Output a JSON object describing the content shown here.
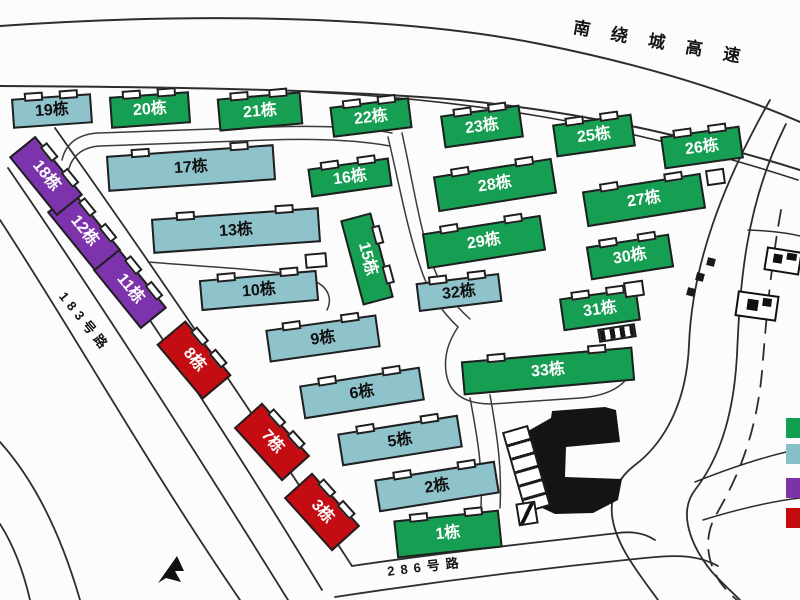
{
  "map": {
    "highway_label": "南绕城高速",
    "road_label_183": "183号路",
    "road_label_286": "286号路"
  },
  "palette": {
    "green": "#169e52",
    "teal": "#8fc3cc",
    "purple": "#7c33ab",
    "red": "#c30d12"
  },
  "text_colors": {
    "green": "#ffffff",
    "teal": "#101010",
    "purple": "#ffffff",
    "red": "#ffffff"
  },
  "legend": [
    {
      "key": "green",
      "color": "#0ea04f"
    },
    {
      "key": "teal",
      "color": "#87c0c9"
    },
    {
      "key": "purple",
      "color": "#7e32a8"
    },
    {
      "key": "red",
      "color": "#c50b0e"
    }
  ],
  "buildings": [
    {
      "label": "1栋",
      "type": "green",
      "x": 448,
      "y": 534,
      "w": 106,
      "h": 38,
      "rot": -6
    },
    {
      "label": "2栋",
      "type": "teal",
      "x": 437,
      "y": 486,
      "w": 122,
      "h": 33,
      "rot": -9
    },
    {
      "label": "3栋",
      "type": "red",
      "x": 322,
      "y": 512,
      "w": 72,
      "h": 38,
      "rot": 48
    },
    {
      "label": "5栋",
      "type": "teal",
      "x": 400,
      "y": 440,
      "w": 122,
      "h": 33,
      "rot": -9
    },
    {
      "label": "6栋",
      "type": "teal",
      "x": 362,
      "y": 393,
      "w": 122,
      "h": 34,
      "rot": -9
    },
    {
      "label": "7栋",
      "type": "red",
      "x": 272,
      "y": 442,
      "w": 72,
      "h": 38,
      "rot": 48
    },
    {
      "label": "8栋",
      "type": "red",
      "x": 194,
      "y": 360,
      "w": 72,
      "h": 38,
      "rot": 50
    },
    {
      "label": "9栋",
      "type": "teal",
      "x": 323,
      "y": 338,
      "w": 112,
      "h": 33,
      "rot": -8
    },
    {
      "label": "10栋",
      "type": "teal",
      "x": 259,
      "y": 290,
      "w": 118,
      "h": 31,
      "rot": -5
    },
    {
      "label": "11栋",
      "type": "purple",
      "x": 130,
      "y": 289,
      "w": 76,
      "h": 34,
      "rot": 51
    },
    {
      "label": "12栋",
      "type": "purple",
      "x": 84,
      "y": 231,
      "w": 76,
      "h": 34,
      "rot": 51
    },
    {
      "label": "13栋",
      "type": "teal",
      "x": 236,
      "y": 230,
      "w": 168,
      "h": 35,
      "rot": -4
    },
    {
      "label": "15栋",
      "type": "green",
      "x": 367,
      "y": 259,
      "w": 88,
      "h": 32,
      "rot": 75
    },
    {
      "label": "16栋",
      "type": "green",
      "x": 350,
      "y": 177,
      "w": 82,
      "h": 29,
      "rot": -8
    },
    {
      "label": "17栋",
      "type": "teal",
      "x": 191,
      "y": 168,
      "w": 168,
      "h": 36,
      "rot": -4
    },
    {
      "label": "18栋",
      "type": "purple",
      "x": 46,
      "y": 176,
      "w": 76,
      "h": 34,
      "rot": 51
    },
    {
      "label": "19栋",
      "type": "teal",
      "x": 52,
      "y": 111,
      "w": 80,
      "h": 30,
      "rot": -4
    },
    {
      "label": "20栋",
      "type": "green",
      "x": 150,
      "y": 110,
      "w": 80,
      "h": 32,
      "rot": -4
    },
    {
      "label": "21栋",
      "type": "green",
      "x": 260,
      "y": 111,
      "w": 84,
      "h": 33,
      "rot": -5
    },
    {
      "label": "22栋",
      "type": "green",
      "x": 371,
      "y": 117,
      "w": 80,
      "h": 31,
      "rot": -7
    },
    {
      "label": "23栋",
      "type": "green",
      "x": 482,
      "y": 126,
      "w": 80,
      "h": 33,
      "rot": -8
    },
    {
      "label": "25栋",
      "type": "green",
      "x": 594,
      "y": 135,
      "w": 80,
      "h": 33,
      "rot": -8
    },
    {
      "label": "26栋",
      "type": "green",
      "x": 702,
      "y": 147,
      "w": 80,
      "h": 33,
      "rot": -8
    },
    {
      "label": "27栋",
      "type": "green",
      "x": 644,
      "y": 200,
      "w": 120,
      "h": 36,
      "rot": -9
    },
    {
      "label": "28栋",
      "type": "green",
      "x": 495,
      "y": 185,
      "w": 120,
      "h": 36,
      "rot": -9
    },
    {
      "label": "29栋",
      "type": "green",
      "x": 484,
      "y": 242,
      "w": 120,
      "h": 36,
      "rot": -9
    },
    {
      "label": "30栋",
      "type": "green",
      "x": 630,
      "y": 257,
      "w": 84,
      "h": 34,
      "rot": -9
    },
    {
      "label": "31栋",
      "type": "green",
      "x": 600,
      "y": 309,
      "w": 78,
      "h": 33,
      "rot": -8
    },
    {
      "label": "32栋",
      "type": "teal",
      "x": 459,
      "y": 292,
      "w": 84,
      "h": 29,
      "rot": -7
    },
    {
      "label": "33栋",
      "type": "green",
      "x": 548,
      "y": 371,
      "w": 172,
      "h": 34,
      "rot": -5
    }
  ]
}
